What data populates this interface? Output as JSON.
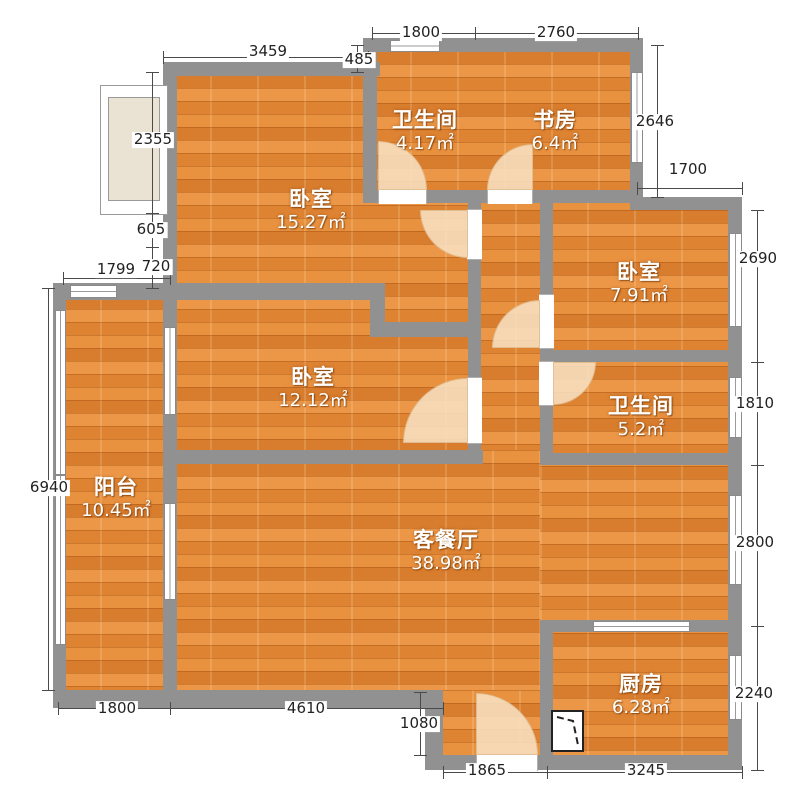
{
  "palette": {
    "floor_base": "#e2873a",
    "wall": "#919191",
    "door_arc_fill": "#f7e0c1",
    "window_fill": "#ffffff",
    "bay_fill": "#eae2d3",
    "dim_text": "#222222",
    "room_text": "#ffffff",
    "background": "#ffffff"
  },
  "rooms": [
    {
      "id": "bathroom-top",
      "name": "卫生间",
      "area": "4.17㎡",
      "cx": 425,
      "cy": 119
    },
    {
      "id": "study",
      "name": "书房",
      "area": "6.4㎡",
      "cx": 555,
      "cy": 119
    },
    {
      "id": "bedroom-large",
      "name": "卧室",
      "area": "15.27㎡",
      "cx": 311,
      "cy": 198
    },
    {
      "id": "bedroom-right",
      "name": "卧室",
      "area": "7.91㎡",
      "cx": 639,
      "cy": 271
    },
    {
      "id": "bedroom-mid",
      "name": "卧室",
      "area": "12.12㎡",
      "cx": 313,
      "cy": 376
    },
    {
      "id": "bathroom-right",
      "name": "卫生间",
      "area": "5.2㎡",
      "cx": 641,
      "cy": 405
    },
    {
      "id": "balcony",
      "name": "阳台",
      "area": "10.45㎡",
      "cx": 116,
      "cy": 486
    },
    {
      "id": "living-dining",
      "name": "客餐厅",
      "area": "38.98㎡",
      "cx": 446,
      "cy": 539
    },
    {
      "id": "kitchen",
      "name": "厨房",
      "area": "6.28㎡",
      "cx": 641,
      "cy": 683
    }
  ],
  "floors": [
    {
      "id": "balcony",
      "r": [
        53,
        283,
        124,
        425
      ]
    },
    {
      "id": "bedrooms-left",
      "r": [
        163,
        62,
        320,
        388
      ]
    },
    {
      "id": "bath-study",
      "r": [
        363,
        38,
        280,
        165
      ]
    },
    {
      "id": "bedroom-bath-right",
      "r": [
        540,
        197,
        202,
        268
      ]
    },
    {
      "id": "corridor",
      "r": [
        468,
        197,
        85,
        268
      ]
    },
    {
      "id": "living-left",
      "r": [
        163,
        450,
        377,
        258
      ]
    },
    {
      "id": "living-right",
      "r": [
        540,
        453,
        202,
        179
      ]
    },
    {
      "id": "entry",
      "r": [
        425,
        690,
        128,
        80
      ]
    },
    {
      "id": "kitchen",
      "r": [
        540,
        620,
        202,
        150
      ]
    }
  ],
  "walls": [
    [
      363,
      38,
      280,
      14
    ],
    [
      163,
      62,
      217,
      14
    ],
    [
      363,
      38,
      14,
      38
    ],
    [
      630,
      38,
      13,
      172
    ],
    [
      630,
      197,
      112,
      13
    ],
    [
      728,
      197,
      14,
      573
    ],
    [
      425,
      755,
      317,
      15
    ],
    [
      425,
      690,
      18,
      80
    ],
    [
      53,
      690,
      390,
      18
    ],
    [
      53,
      283,
      13,
      425
    ],
    [
      53,
      283,
      124,
      17
    ],
    [
      163,
      283,
      14,
      425
    ],
    [
      163,
      62,
      14,
      238
    ],
    [
      363,
      38,
      14,
      165
    ],
    [
      363,
      190,
      280,
      13
    ],
    [
      163,
      283,
      222,
      17
    ],
    [
      370,
      283,
      15,
      54
    ],
    [
      370,
      322,
      100,
      15
    ],
    [
      468,
      203,
      13,
      261
    ],
    [
      540,
      197,
      13,
      268
    ],
    [
      540,
      350,
      202,
      12
    ],
    [
      540,
      453,
      202,
      12
    ],
    [
      163,
      450,
      320,
      14
    ],
    [
      540,
      620,
      202,
      12
    ],
    [
      540,
      620,
      13,
      150
    ]
  ],
  "door_gaps": [
    {
      "o": "h",
      "r": [
        378,
        189,
        49,
        15
      ]
    },
    {
      "o": "h",
      "r": [
        487,
        189,
        46,
        15
      ]
    },
    {
      "o": "v",
      "r": [
        467,
        209,
        15,
        51
      ]
    },
    {
      "o": "v",
      "r": [
        467,
        377,
        15,
        67
      ]
    },
    {
      "o": "v",
      "r": [
        539,
        294,
        15,
        55
      ]
    },
    {
      "o": "v",
      "r": [
        539,
        361,
        15,
        45
      ]
    },
    {
      "o": "h",
      "r": [
        476,
        754,
        62,
        17
      ]
    }
  ],
  "doors": [
    {
      "id": "door-bathroom-top",
      "x": 378,
      "y": 141,
      "s": 49,
      "round": "tr"
    },
    {
      "id": "door-study",
      "x": 487,
      "y": 144,
      "s": 46,
      "round": "tl"
    },
    {
      "id": "door-bedroom-large",
      "x": 420,
      "y": 210,
      "s": 48,
      "round": "bl"
    },
    {
      "id": "door-bedroom-right",
      "x": 492,
      "y": 300,
      "s": 48,
      "round": "tl"
    },
    {
      "id": "door-bedroom-mid",
      "x": 403,
      "y": 378,
      "s": 65,
      "round": "tl"
    },
    {
      "id": "door-bathroom-right",
      "x": 553,
      "y": 362,
      "s": 43,
      "round": "br"
    },
    {
      "id": "door-entry",
      "x": 476,
      "y": 693,
      "s": 62,
      "round": "tr"
    }
  ],
  "windows": [
    {
      "id": "balcony-top-window",
      "o": "h",
      "r": [
        70,
        285,
        47,
        13
      ]
    },
    {
      "id": "balcony-left-window-1",
      "o": "v",
      "r": [
        55,
        310,
        11,
        165
      ]
    },
    {
      "id": "balcony-left-window-2",
      "o": "v",
      "r": [
        55,
        475,
        11,
        170
      ]
    },
    {
      "id": "balcony-bedroom-window",
      "o": "v",
      "r": [
        164,
        327,
        12,
        88
      ]
    },
    {
      "id": "balcony-living-window",
      "o": "v",
      "r": [
        164,
        503,
        12,
        97
      ]
    },
    {
      "id": "bathroom-top-window",
      "o": "h",
      "r": [
        390,
        40,
        50,
        12
      ]
    },
    {
      "id": "study-window",
      "o": "v",
      "r": [
        631,
        72,
        12,
        91
      ]
    },
    {
      "id": "bedroom-right-window",
      "o": "v",
      "r": [
        729,
        233,
        13,
        94
      ]
    },
    {
      "id": "bathroom-right-window",
      "o": "v",
      "r": [
        729,
        377,
        13,
        61
      ]
    },
    {
      "id": "living-right-window",
      "o": "v",
      "r": [
        729,
        495,
        13,
        90
      ]
    },
    {
      "id": "kitchen-right-window",
      "o": "v",
      "r": [
        729,
        655,
        13,
        65
      ]
    },
    {
      "id": "kitchen-top-window",
      "o": "h",
      "r": [
        593,
        621,
        97,
        11
      ]
    }
  ],
  "bay_window": {
    "outer": [
      100,
      85,
      68,
      130
    ],
    "inner": [
      108,
      97,
      52,
      104
    ]
  },
  "kitchen_fixture": {
    "r": [
      551,
      710,
      33,
      42
    ]
  },
  "dimensions": [
    {
      "id": "dim-top-1800",
      "o": "h",
      "x": 372,
      "y": 33,
      "len": 103,
      "label": "1800",
      "lx": 421,
      "ly": 33
    },
    {
      "id": "dim-top-2760",
      "o": "h",
      "x": 475,
      "y": 33,
      "len": 163,
      "label": "2760",
      "lx": 556,
      "ly": 33
    },
    {
      "id": "dim-top-3459",
      "o": "h",
      "x": 163,
      "y": 57,
      "len": 205,
      "label": "3459",
      "lx": 268,
      "ly": 52
    },
    {
      "id": "dim-top-485",
      "o": "v",
      "x": 357,
      "y": 45,
      "len": 27,
      "label": "485",
      "lx": 359,
      "ly": 60
    },
    {
      "id": "dim-right-2646",
      "o": "v",
      "x": 657,
      "y": 45,
      "len": 152,
      "label": "2646",
      "lx": 655,
      "ly": 122
    },
    {
      "id": "dim-right-1700",
      "o": "h",
      "x": 637,
      "y": 188,
      "len": 105,
      "label": "1700",
      "lx": 688,
      "ly": 170
    },
    {
      "id": "dim-right-2690",
      "o": "v",
      "x": 757,
      "y": 210,
      "len": 152,
      "label": "2690",
      "lx": 758,
      "ly": 259
    },
    {
      "id": "dim-right-1810",
      "o": "v",
      "x": 757,
      "y": 362,
      "len": 103,
      "label": "1810",
      "lx": 755,
      "ly": 404
    },
    {
      "id": "dim-right-2800",
      "o": "v",
      "x": 757,
      "y": 465,
      "len": 161,
      "label": "2800",
      "lx": 755,
      "ly": 543
    },
    {
      "id": "dim-right-2240",
      "o": "v",
      "x": 757,
      "y": 626,
      "len": 144,
      "label": "2240",
      "lx": 754,
      "ly": 694
    },
    {
      "id": "dim-left-6940",
      "o": "v",
      "x": 48,
      "y": 288,
      "len": 402,
      "label": "6940",
      "lx": 49,
      "ly": 488
    },
    {
      "id": "dim-left-2355",
      "o": "v",
      "x": 152,
      "y": 72,
      "len": 141,
      "label": "2355",
      "lx": 153,
      "ly": 140
    },
    {
      "id": "dim-left-605",
      "o": "v",
      "x": 152,
      "y": 213,
      "len": 34,
      "label": "605",
      "lx": 151,
      "ly": 230
    },
    {
      "id": "dim-left-720",
      "o": "v",
      "x": 152,
      "y": 247,
      "len": 41,
      "label": "720",
      "lx": 156,
      "ly": 267
    },
    {
      "id": "dim-left-1799",
      "o": "h",
      "x": 63,
      "y": 278,
      "len": 107,
      "label": "1799",
      "lx": 116,
      "ly": 270
    },
    {
      "id": "dim-bottom-1800",
      "o": "h",
      "x": 58,
      "y": 708,
      "len": 112,
      "label": "1800",
      "lx": 117,
      "ly": 709
    },
    {
      "id": "dim-bottom-4610",
      "o": "h",
      "x": 170,
      "y": 708,
      "len": 273,
      "label": "4610",
      "lx": 306,
      "ly": 709
    },
    {
      "id": "dim-bottom-1080",
      "o": "v",
      "x": 420,
      "y": 692,
      "len": 63,
      "label": "1080",
      "lx": 419,
      "ly": 724
    },
    {
      "id": "dim-bottom-1865",
      "o": "h",
      "x": 443,
      "y": 772,
      "len": 104,
      "label": "1865",
      "lx": 487,
      "ly": 771
    },
    {
      "id": "dim-bottom-3245",
      "o": "h",
      "x": 547,
      "y": 772,
      "len": 195,
      "label": "3245",
      "lx": 646,
      "ly": 771
    }
  ]
}
